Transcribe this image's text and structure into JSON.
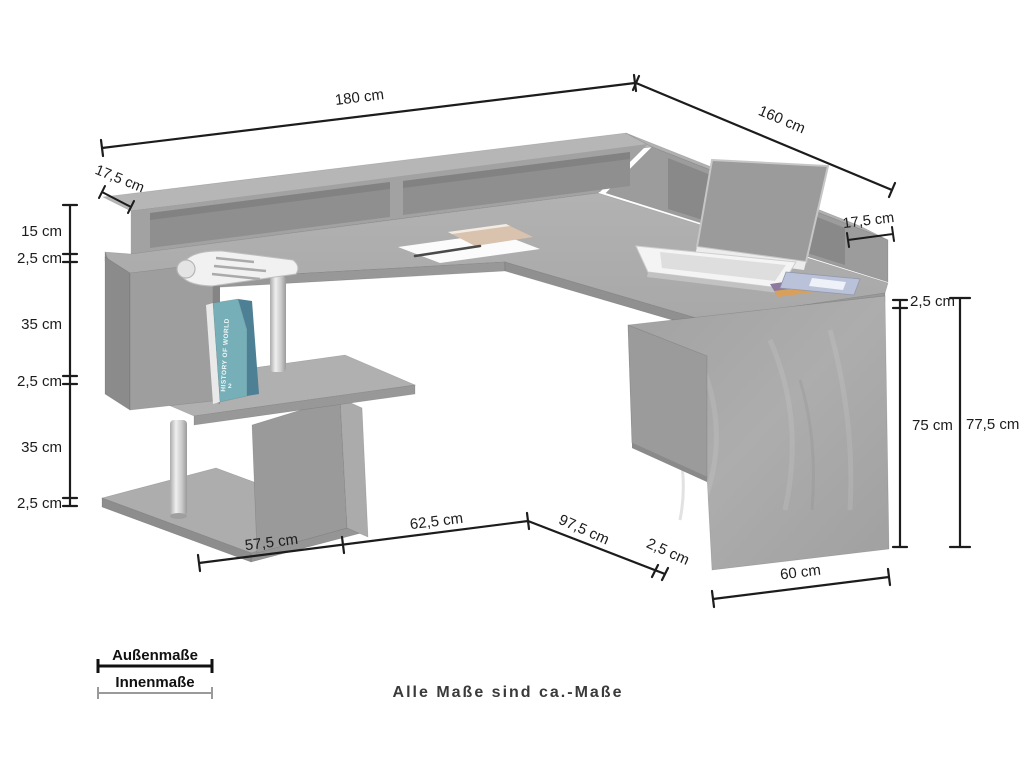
{
  "dims": {
    "top_width": "180 cm",
    "top_depth": "160 cm",
    "riser_depth_left": "17,5 cm",
    "riser_depth_right": "17,5 cm",
    "left": [
      "15 cm",
      "2,5 cm",
      "35 cm",
      "2,5 cm",
      "35 cm",
      "2,5 cm"
    ],
    "right": [
      "2,5 cm",
      "75 cm",
      "77,5 cm"
    ],
    "bottom": [
      "57,5 cm",
      "62,5 cm",
      "97,5 cm",
      "2,5 cm",
      "60 cm"
    ]
  },
  "legend": {
    "outer": "Außenmaße",
    "inner": "Innenmaße"
  },
  "footer": {
    "note": "Alle Maße sind ca.-Maße"
  },
  "product": {
    "book_spine": "HISTORY OF WORLD",
    "book_spine_number": "2"
  },
  "colors": {
    "line": "#1c1c1c",
    "desk_top": "#aeaeae",
    "desk_front": "#989898",
    "riser_top": "#b6b6b6",
    "riser_front": "#a2a2a2",
    "opening": "#8f8f8f",
    "panel": "#a7a7a7",
    "inner_measure_line": "#9a9a9a",
    "book_teal": "#76afb8"
  }
}
